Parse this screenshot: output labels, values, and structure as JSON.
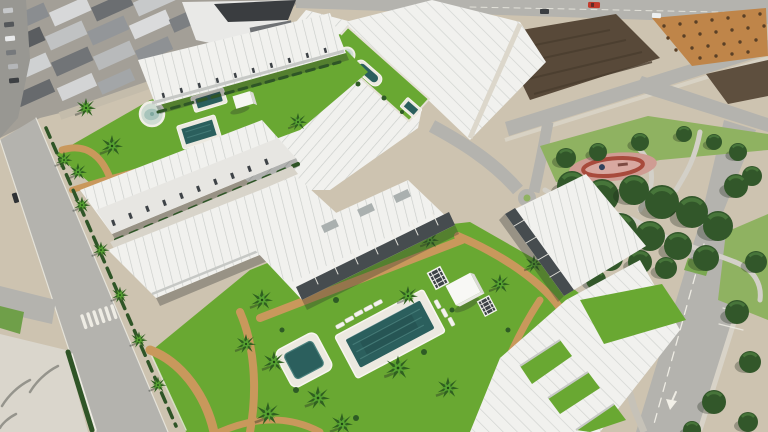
{
  "scene": {
    "setting": "Aerial 3D render of a new-build residential development: white townhouses around landscaped courtyards with pools and palms, beside an existing town, vacant plots, access streets and a mature public park",
    "areas": {
      "existing_town": "Existing town rooftops with street parking (top left)",
      "north_courtyard": "Courtyard garden with round fountain, two small pools and a pool house",
      "linear_garden": "Long lawn spine with round fountain, lap pool and plunge pool between townhouse rows",
      "main_garden": "Main communal garden with large pool, kids pool, sun loungers, palms, pavilion and pergolas",
      "public_park": "Public park with dense trees, winding paths and a playground",
      "vacant_plots": "Unbuilt dirt plots along the access roads (top right)",
      "streets": "Streets with zebra crossing, cycle lane, parking bays and a painted turn arrow"
    },
    "counts": {
      "fountains": 2,
      "pools": 6,
      "playgrounds": 1,
      "palm_trees": 30
    }
  },
  "palette": {
    "sand": "#cdc3b0",
    "road": "#b4b3ae",
    "roadOld": "#989792",
    "concrete": "#dad6cc",
    "lawn": "#69a832",
    "lawnDark": "#4e8a26",
    "parkLawn": "#8fb261",
    "parkTree": "#32572a",
    "parkTreeLight": "#47753a",
    "pathTan": "#c9985c",
    "building": "#f1f1ee",
    "buildingShade": "#c6c8c5",
    "facade": "#e7e6e2",
    "ridge": "#cbcecb",
    "windowDark": "#3e4347",
    "terraceDark": "#464c4f",
    "poolDeck": "#ece9e0",
    "poolWater": "#2b5f5d",
    "poolWaterLight": "#4a817d",
    "fountainWater": "#a8c4bb",
    "hedge": "#2f5527",
    "palmDark": "#2f6020",
    "palmLight": "#55a131",
    "trunk": "#8a6f4e",
    "dirtDark": "#584939",
    "dirtOrange": "#bf8549",
    "townRoofLight": "#d7d8d9",
    "townRoofMid": "#8a8d90",
    "townRoofDark": "#54585b",
    "warehouseRoof": "#3a3d40",
    "whiteline": "#eeece4",
    "carRed": "#c23a2b",
    "playgroundBase": "#cf9c93",
    "playgroundRing": "#a84a3c",
    "shadow": "rgba(40,45,42,0.32)"
  }
}
